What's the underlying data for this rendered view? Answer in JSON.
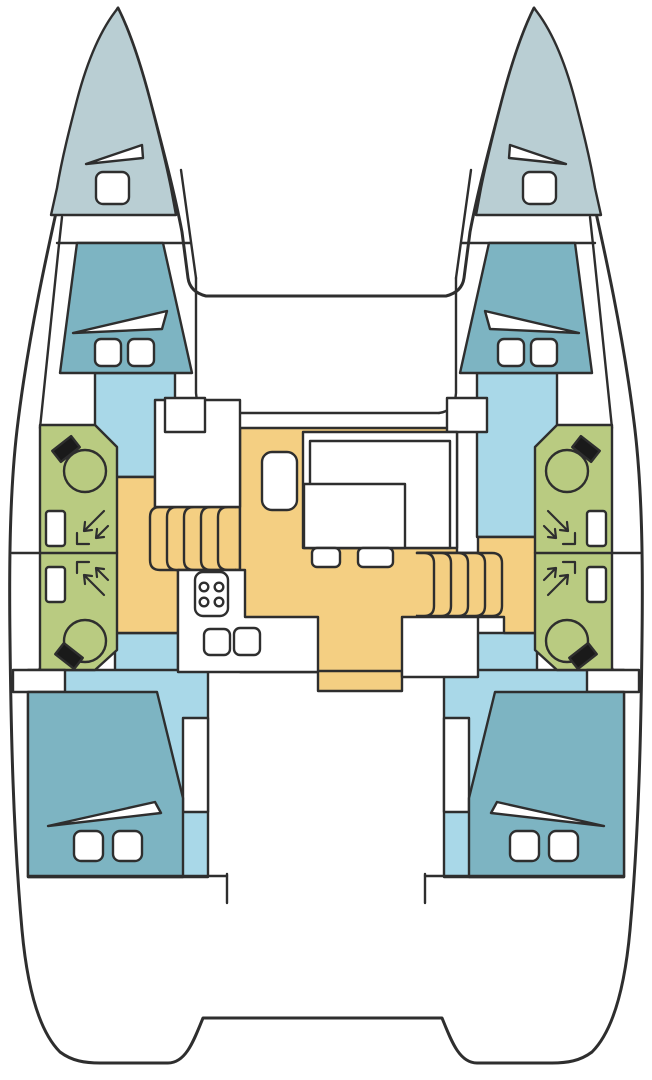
{
  "title": "catamaran-deck-plan",
  "colors": {
    "outline": "#2e2e2e",
    "hull": "#ffffff",
    "bow_deck": "#b9ced3",
    "berth": "#7db4c2",
    "floor": "#a9d8e8",
    "bathroom": "#b9cb81",
    "salon": "#f4cf82",
    "fixture_black": "#1a1a1a"
  },
  "components": {
    "hull": "catamaran-hull-outline",
    "bow": "bow-deck",
    "bow_hatch": "deck-hatch-icon",
    "bow_vent": "sail-locker-hatch-icon",
    "berth": "double-berth",
    "pillow": "pillow-icon",
    "duvet": "duvet-fold-icon",
    "bathroom": "shower-room",
    "toilet": "toilet-icon",
    "shower": "shower-spray-icon",
    "basin": "washbasin-icon",
    "steps": "companionway-steps",
    "galley": "galley-counter",
    "stove": "stove-4-burner-icon",
    "sink": "galley-sink-icon",
    "settee": "salon-settee",
    "table": "salon-table",
    "seat": "salon-seat",
    "nav": "nav-station-block"
  }
}
